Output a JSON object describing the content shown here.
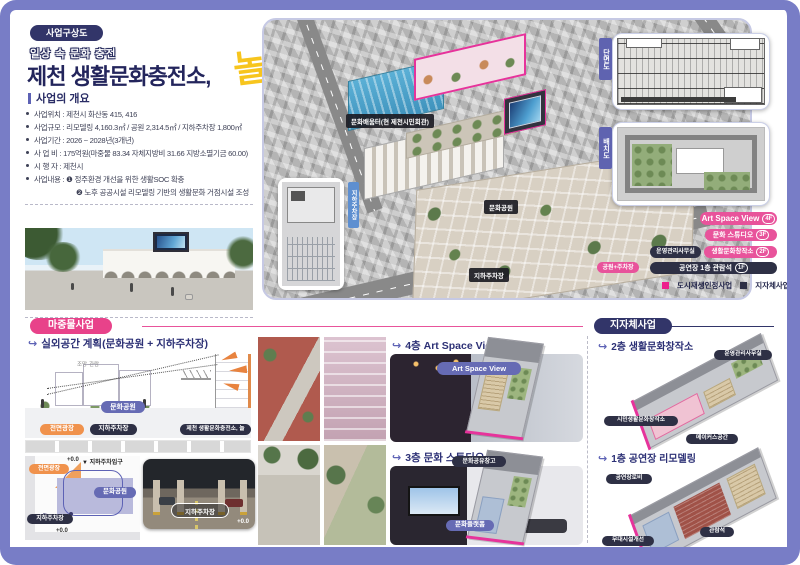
{
  "colors": {
    "frame": "#787dc6",
    "pink": "#e8539b",
    "magenta": "#ed1e8c",
    "navy": "#2e3045",
    "purple": "#666bb4",
    "orange": "#f0924c",
    "yellow": "#f7c51e",
    "blue_roof": "#4aa3cc",
    "steel_blue": "#5e8fd0"
  },
  "ui": {
    "arrow_icon": "↪",
    "down_triangle": "▼"
  },
  "header": {
    "badge": "사업구상도",
    "tagline": "일상 속 문화 충전",
    "title": "제천 생활문화충전소,",
    "title_accent": "놀",
    "overview_heading": "사업의 개요",
    "overview_items": [
      "사업위치 : 제천시 화산동 415, 416",
      "사업규모 : 리모델링 4,160.3㎡ / 공원 2,314.5㎡ / 지하주차장 1,800㎡",
      "사업기간 : 2026 ~ 2028년(3개년)",
      "사 업 비 : 175억원(마중물 83.34 자체지방비 31.66 지방소멸기금 60.00)",
      "시 행 자 : 제천시",
      "사업내용 : ❶ 정주환경 개선을 위한 생활SOC 확충",
      "❷ 노후 공공시설 리모델링 기반의 생활문화 거점시설 조성"
    ]
  },
  "aerial": {
    "building_label": "문화배움터(현 제천시민회관)",
    "park_label": "문화공원",
    "parking_label": "지하주차장",
    "inset_tab": "지하주차장",
    "section_tab": "단면도",
    "siteplan_tab": "배치도",
    "floor_tags": {
      "f4": {
        "label": "Art Space View",
        "floor": "4F"
      },
      "f3": {
        "label": "문화 스튜디오",
        "floor": "3F"
      },
      "f2_office": "운영관리사무실",
      "f2": {
        "label": "생활문화창작소",
        "floor": "2F"
      },
      "f1_park": "공원+주차장",
      "f1": {
        "label": "공연장 1층 관람석",
        "floor": "1F"
      }
    },
    "legend": [
      {
        "label": "도시재생인정사업",
        "color": "#ed1e8c"
      },
      {
        "label": "지자체사업",
        "color": "#2e3045"
      }
    ]
  },
  "seed": {
    "badge": "마중물사업",
    "outdoor": {
      "heading": "실외공간 계획(문화공원 + 지하주차장)",
      "view_note": "조망·관람",
      "plaza": "전면광장",
      "parking": "지하주차장",
      "park": "문화공원",
      "building": "제천 생활문화충전소, 놀"
    },
    "plan": {
      "level_top": "+0.0",
      "entry": "지하주차입구",
      "plaza": "전면광장",
      "park": "문화공원",
      "parking": "지하주차장",
      "level_left": "+0.0",
      "photo_label": "지하주차장",
      "level_right": "+0.0"
    },
    "floor4": {
      "heading": "4층 Art Space View",
      "badge": "Art Space View"
    },
    "floor3": {
      "heading": "3층 문화 스튜디오",
      "badge_top": "문화공유창고",
      "badge_bottom": "문화플랫폼"
    }
  },
  "municipal": {
    "badge": "지자체사업",
    "floor2": {
      "heading": "2층 생활문화창작소",
      "badge_office": "운영관리사무실",
      "badge_main": "시민생활문화창작소",
      "badge_maker": "메이커스공간"
    },
    "floor1": {
      "heading": "1층 공연장 리모델링",
      "badge_lobby": "공연장로비",
      "badge_seats": "관람석",
      "badge_stage": "무대시설개선"
    }
  }
}
